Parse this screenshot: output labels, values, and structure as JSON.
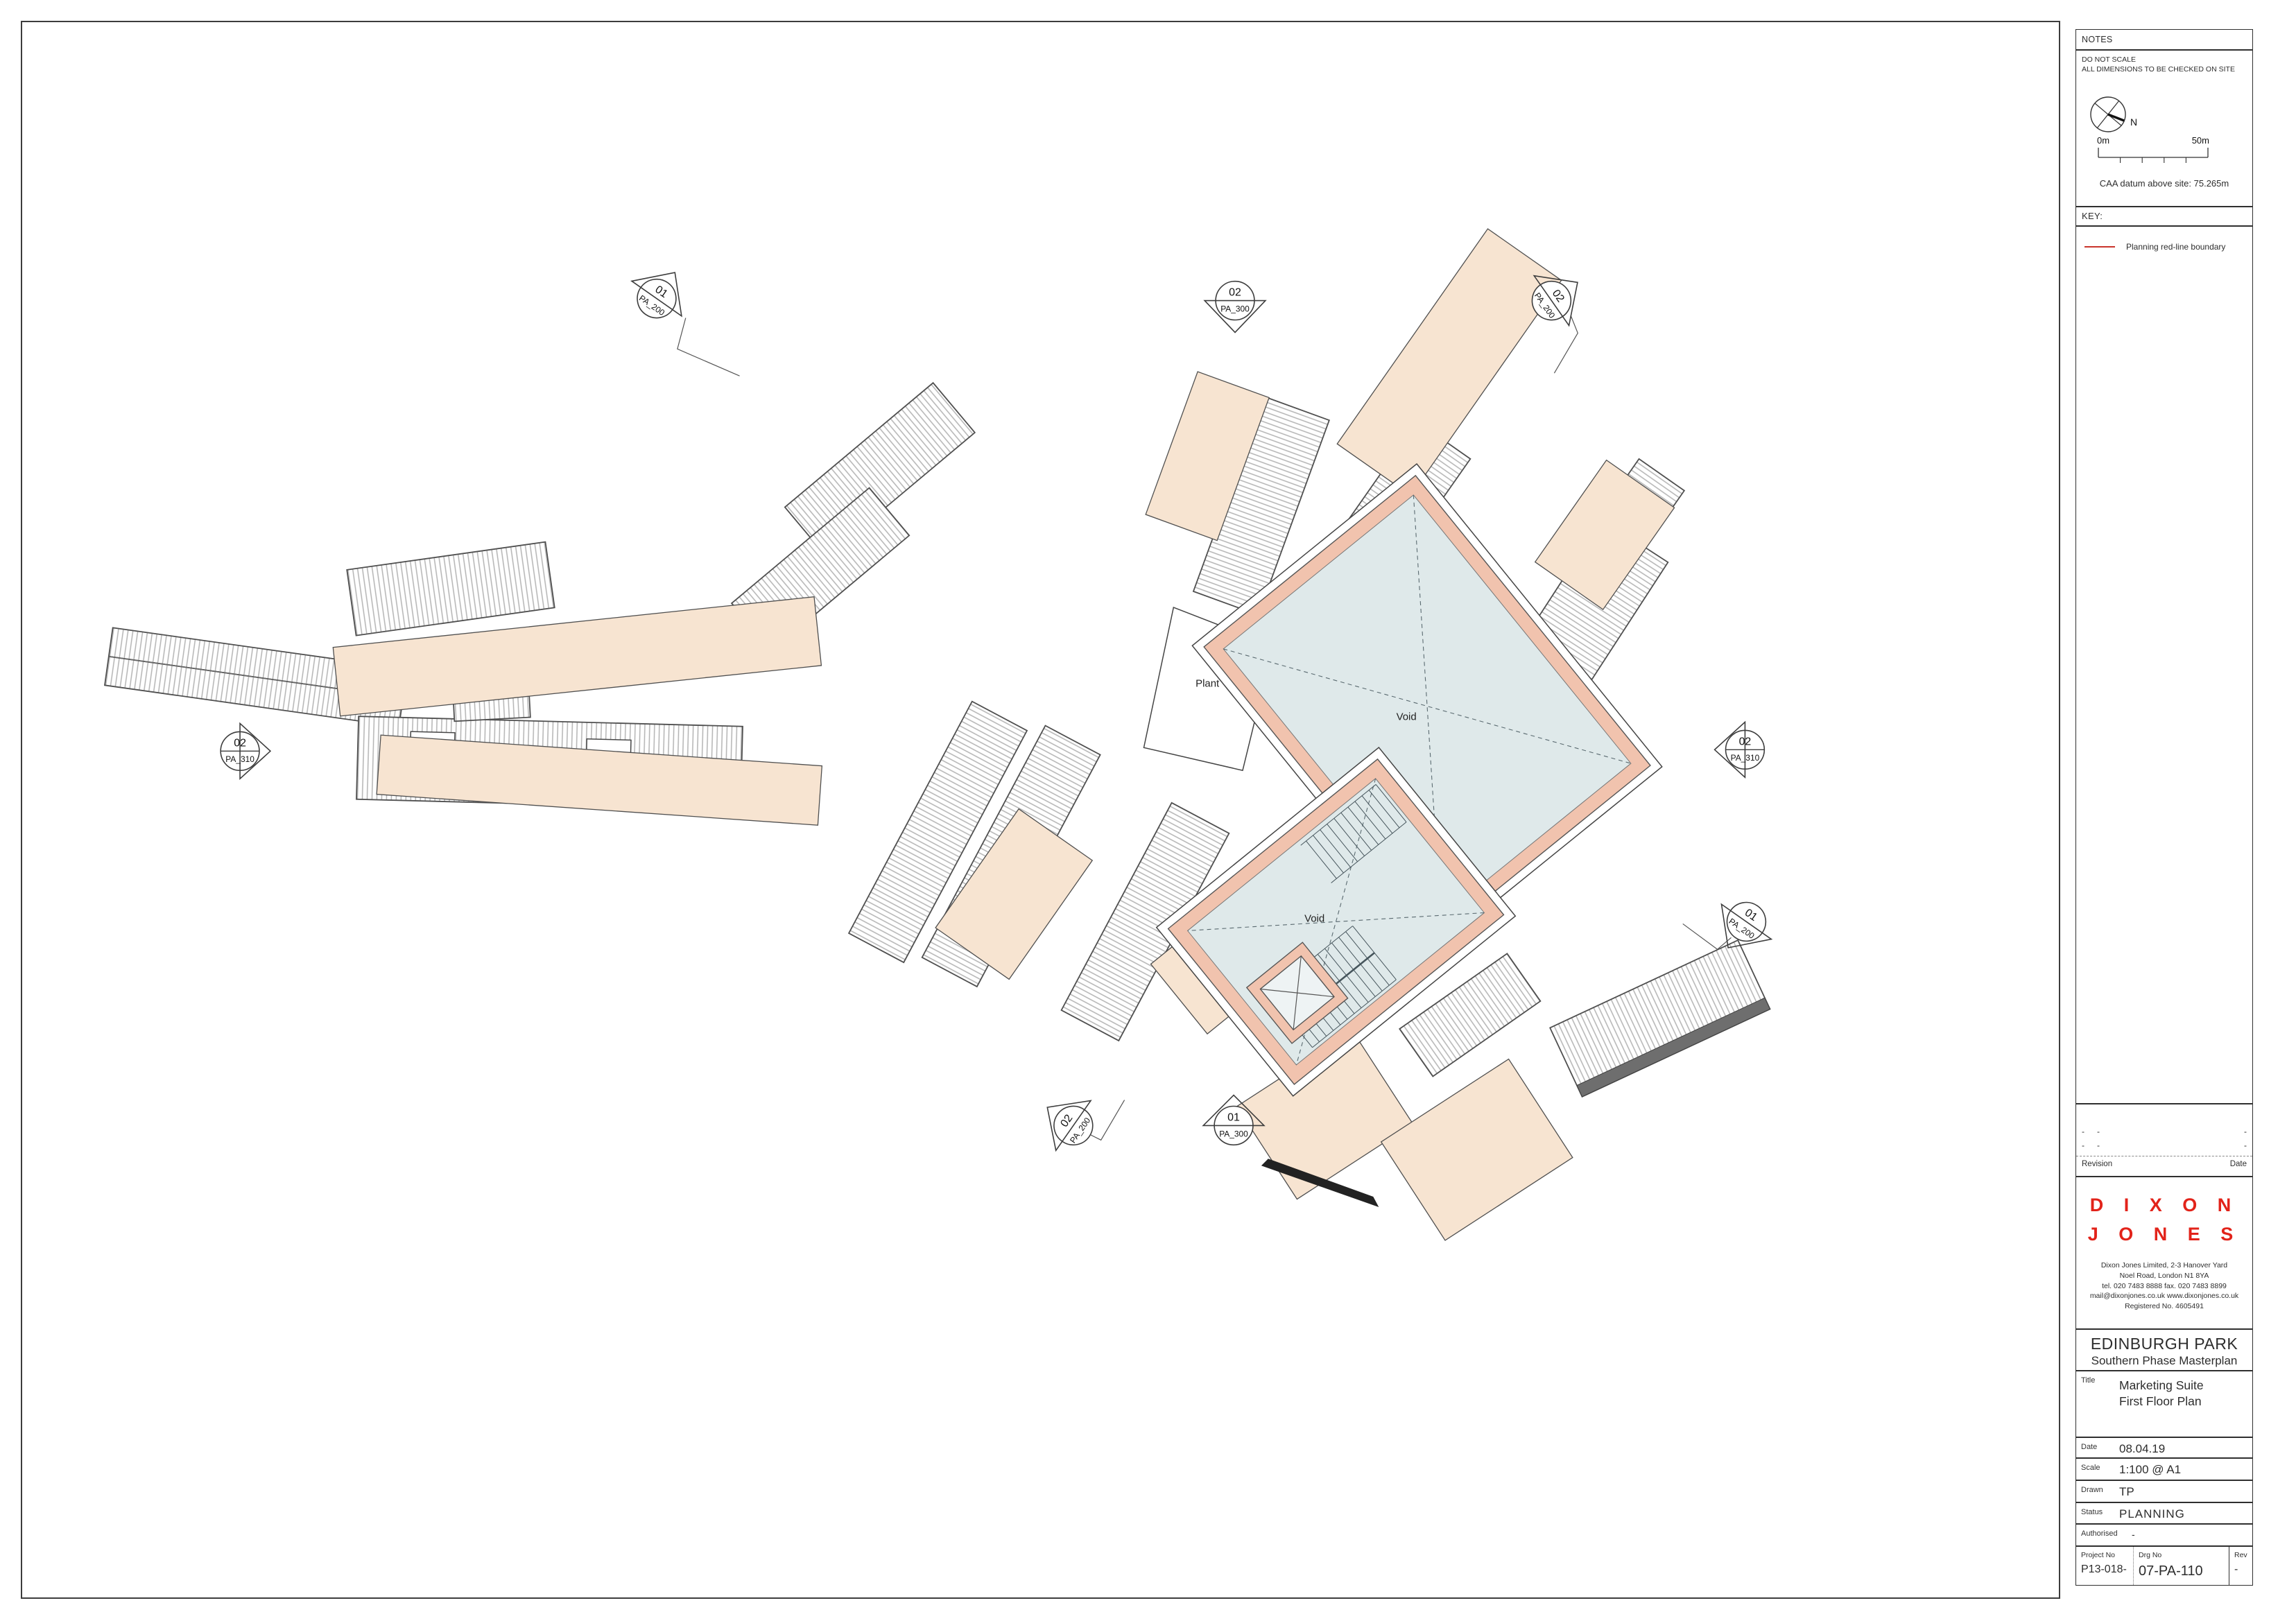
{
  "plan": {
    "labels": {
      "plant": "Plant",
      "void_main": "Void",
      "void_stair": "Void"
    },
    "markers": [
      {
        "num": "01",
        "ref": "PA_200"
      },
      {
        "num": "02",
        "ref": "PA_300"
      },
      {
        "num": "02",
        "ref": "PA_200"
      },
      {
        "num": "02",
        "ref": "PA_310"
      },
      {
        "num": "02",
        "ref": "PA_310"
      },
      {
        "num": "01",
        "ref": "PA_200"
      },
      {
        "num": "02",
        "ref": "PA_200"
      },
      {
        "num": "01",
        "ref": "PA_300"
      }
    ],
    "colors": {
      "terrace": "#f7e4d1",
      "wall": "#f1c3ae",
      "void_fill": "#dfe9ea",
      "rib": "#b3b3b3",
      "red_line": "#c9342b"
    }
  },
  "panel": {
    "notes": {
      "header": "NOTES",
      "line1": "DO NOT SCALE",
      "line2": "ALL DIMENSIONS TO BE CHECKED ON SITE",
      "north_label": "N",
      "scale_start": "0m",
      "scale_end": "50m",
      "datum": "CAA datum above site: 75.265m"
    },
    "key": {
      "header": "KEY:",
      "item1": "Planning red-line boundary"
    },
    "revision": {
      "rows": [
        [
          "-",
          "-",
          "-"
        ],
        [
          "-",
          "-",
          "-"
        ]
      ],
      "left_label": "Revision",
      "right_label": "Date"
    },
    "firm": {
      "line1": "D I X O N",
      "line2": "J O N E S",
      "address": [
        "Dixon Jones Limited, 2-3 Hanover Yard",
        "Noel Road, London N1 8YA",
        "tel. 020 7483 8888  fax. 020 7483 8899",
        "mail@dixonjones.co.uk  www.dixonjones.co.uk",
        "Registered No. 4605491"
      ]
    },
    "project": {
      "name": "EDINBURGH PARK",
      "subtitle": "Southern Phase Masterplan"
    },
    "fields": {
      "title_label": "Title",
      "title1": "Marketing Suite",
      "title2": "First Floor Plan",
      "date_label": "Date",
      "date": "08.04.19",
      "scale_label": "Scale",
      "scale": "1:100 @ A1",
      "drawn_label": "Drawn",
      "drawn": "TP",
      "status_label": "Status",
      "status": "PLANNING",
      "authorised_label": "Authorised",
      "authorised": "-",
      "project_no_label": "Project No",
      "project_no": "P13-018-",
      "drg_no_label": "Drg No",
      "drg_no": "07-PA-110",
      "rev_label": "Rev",
      "rev": "-"
    }
  }
}
